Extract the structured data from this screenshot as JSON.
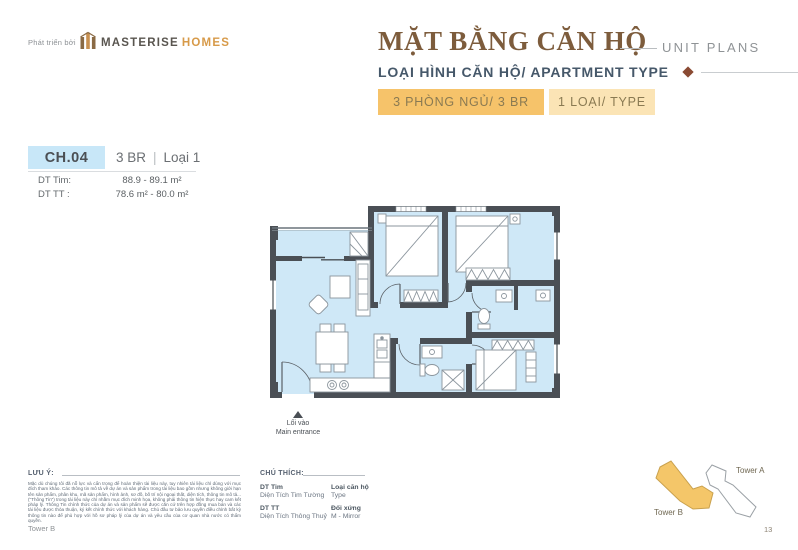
{
  "brand": {
    "prefix": "Phát triển bởi",
    "primary": "MASTERISE",
    "secondary": "HOMES"
  },
  "header": {
    "title_vi": "MẶT BẰNG CĂN HỘ",
    "title_en": "UNIT PLANS",
    "subtitle": "LOẠI HÌNH CĂN HỘ/ APARTMENT TYPE",
    "badge_bedrooms": "3 PHÒNG NGỦ/ 3 BR",
    "badge_types": "1 LOẠI/ TYPE"
  },
  "unit": {
    "code": "CH.04",
    "bedrooms": "3 BR",
    "divider": "|",
    "variant": "Loại 1",
    "areas": [
      {
        "label": "DT Tim:",
        "value": "88.9 - 89.1 m²"
      },
      {
        "label": "DT TT :",
        "value": "78.6 m² - 80.0 m²"
      }
    ]
  },
  "floorplan": {
    "entrance_vi": "Lối vào",
    "entrance_en": "Main entrance"
  },
  "notes": {
    "heading": "LƯU Ý:",
    "body": "Mặc dù chúng tôi đã nỗ lực và cẩn trọng để hoàn thiện tài liệu này, tuy nhiên tài liệu chỉ dùng với mục đích tham khảo. Các thông tin mô tả về dự án và sản phẩm trong tài liệu bao gồm nhưng không giới hạn tên sản phẩm, phân khu, mã sản phẩm, hình ảnh, sơ đồ, bố trí nội ngoại thất, diện tích, thông tin mô tả... (\"Thông Tin\") trong tài liệu này chỉ nhằm mục đích minh họa, không phải thông tin hiện thực hay cam kết pháp lý. Thông Tin chính thức của dự án và sản phẩm sẽ được căn cứ trên hợp đồng mua bán và các tài liệu được thỏa thuận, ký kết chính thức với khách hàng. Chủ đầu tư bảo lưu quyền điều chỉnh bất kỳ thông tin nào để phù hợp với hồ sơ pháp lý của dự án và yêu cầu của cơ quan nhà nước có thẩm quyền."
  },
  "legend": {
    "heading": "CHÚ THÍCH:",
    "items": [
      {
        "term": "DT Tim",
        "definition": "Diện Tích Tim Tường"
      },
      {
        "term": "Loại căn hộ",
        "definition": "Type"
      },
      {
        "term": "DT TT",
        "definition": "Diện Tích Thông Thuỷ"
      },
      {
        "term": "Đối xứng",
        "definition": "M - Mirror"
      }
    ]
  },
  "site_plan": {
    "tower_a": "Tower A",
    "tower_b": "Tower B"
  },
  "footer": {
    "left": "Tower B",
    "page": "13"
  },
  "colors": {
    "accent_gold": "#f6c36a",
    "accent_cream": "#fbe4b5",
    "title_brown": "#7d5c3c",
    "subtitle_slate": "#46586a",
    "diamond_maroon": "#8a4a33",
    "chip_blue": "#c8e7f8",
    "wall_dark": "#4a4f55",
    "floor_blue": "#cfe8f7",
    "tower_fill": "#f4c669"
  }
}
